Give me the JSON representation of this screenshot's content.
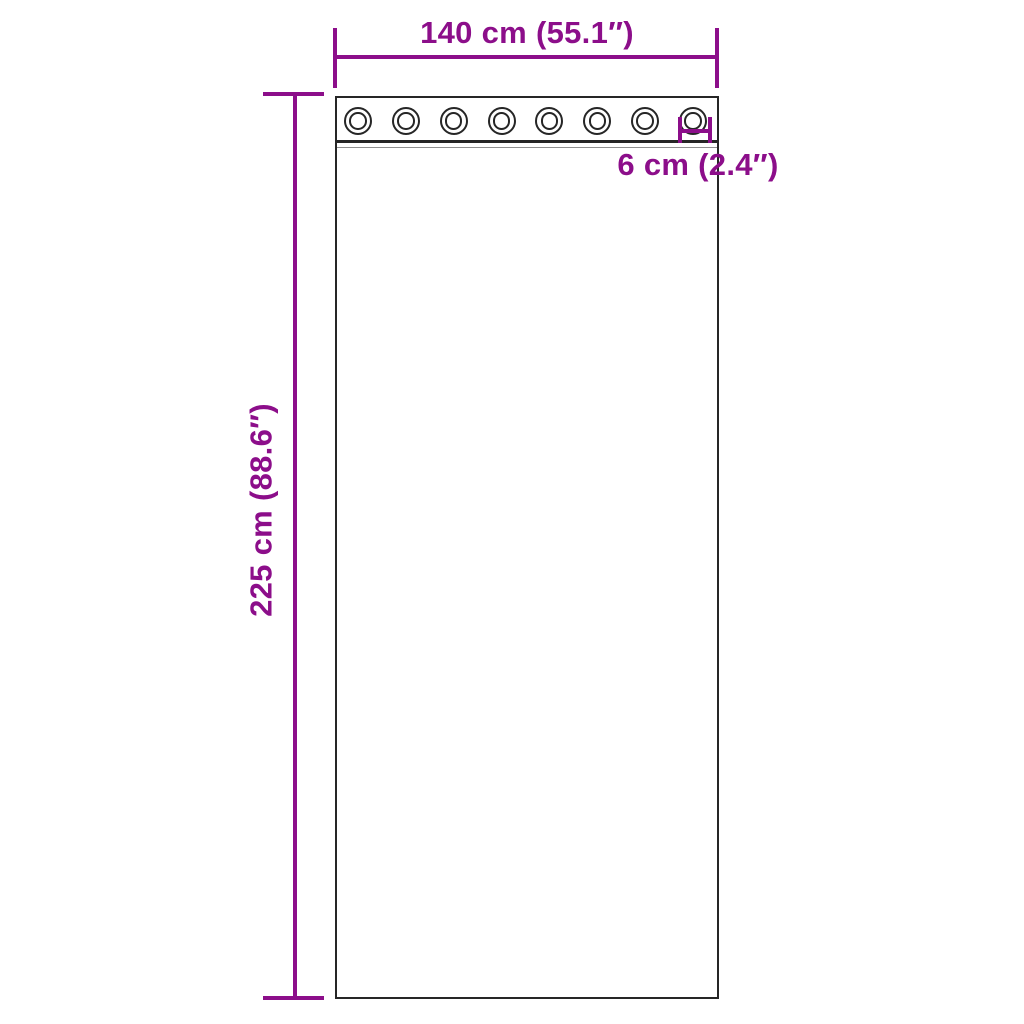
{
  "diagram": {
    "width_label": "140 cm (55.1″)",
    "height_label": "225 cm (88.6″)",
    "grommet_label": "6 cm (2.4″)",
    "eyelets": {
      "count": 8
    },
    "colors": {
      "dimension": "#8C0E8A",
      "outline": "#262626",
      "stitch": "#8f8f8f",
      "background": "#ffffff"
    }
  }
}
